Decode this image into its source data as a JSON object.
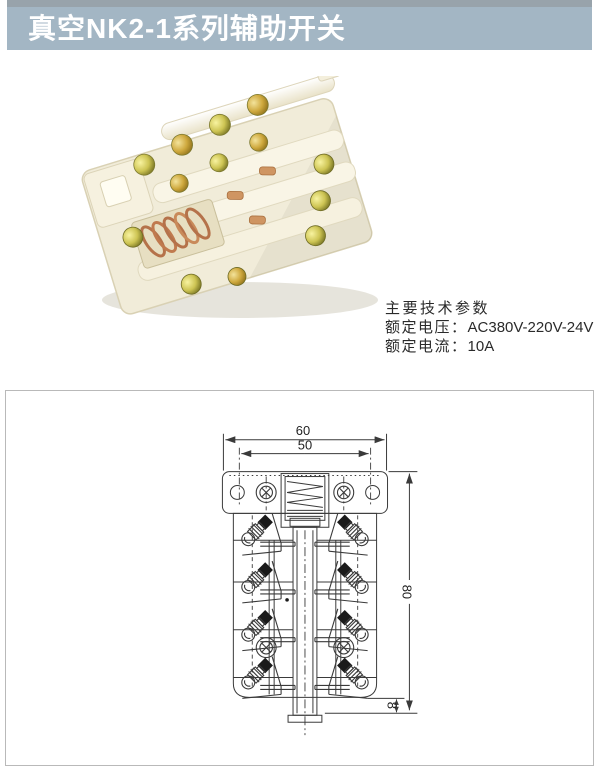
{
  "header": {
    "title": "真空NK2-1系列辅助开关",
    "bar_color": "#a3b6c4",
    "strip_color": "#98a3ab",
    "text_color": "#ffffff"
  },
  "photo": {
    "description": "NK2-1 auxiliary switch, ivory plastic body with brass screws and copper spring",
    "body_color": "#f1ecd9",
    "screw_color": "#cdc453",
    "spring_color": "#b5724a",
    "rod_color": "#fbf8ec",
    "shadow_color": "#d8d5ca"
  },
  "specs": {
    "heading": "主要技术参数",
    "rows": [
      {
        "label": "额定电压：",
        "value": "AC380V-220V-24V"
      },
      {
        "label": "额定电流：",
        "value": "10A"
      }
    ]
  },
  "drawing": {
    "border_color": "#b9b9b9",
    "line_color": "#3a3a3a",
    "dims": {
      "outer_width": "60",
      "hole_spacing": "50",
      "body_height": "80",
      "stem_height": "8"
    }
  }
}
